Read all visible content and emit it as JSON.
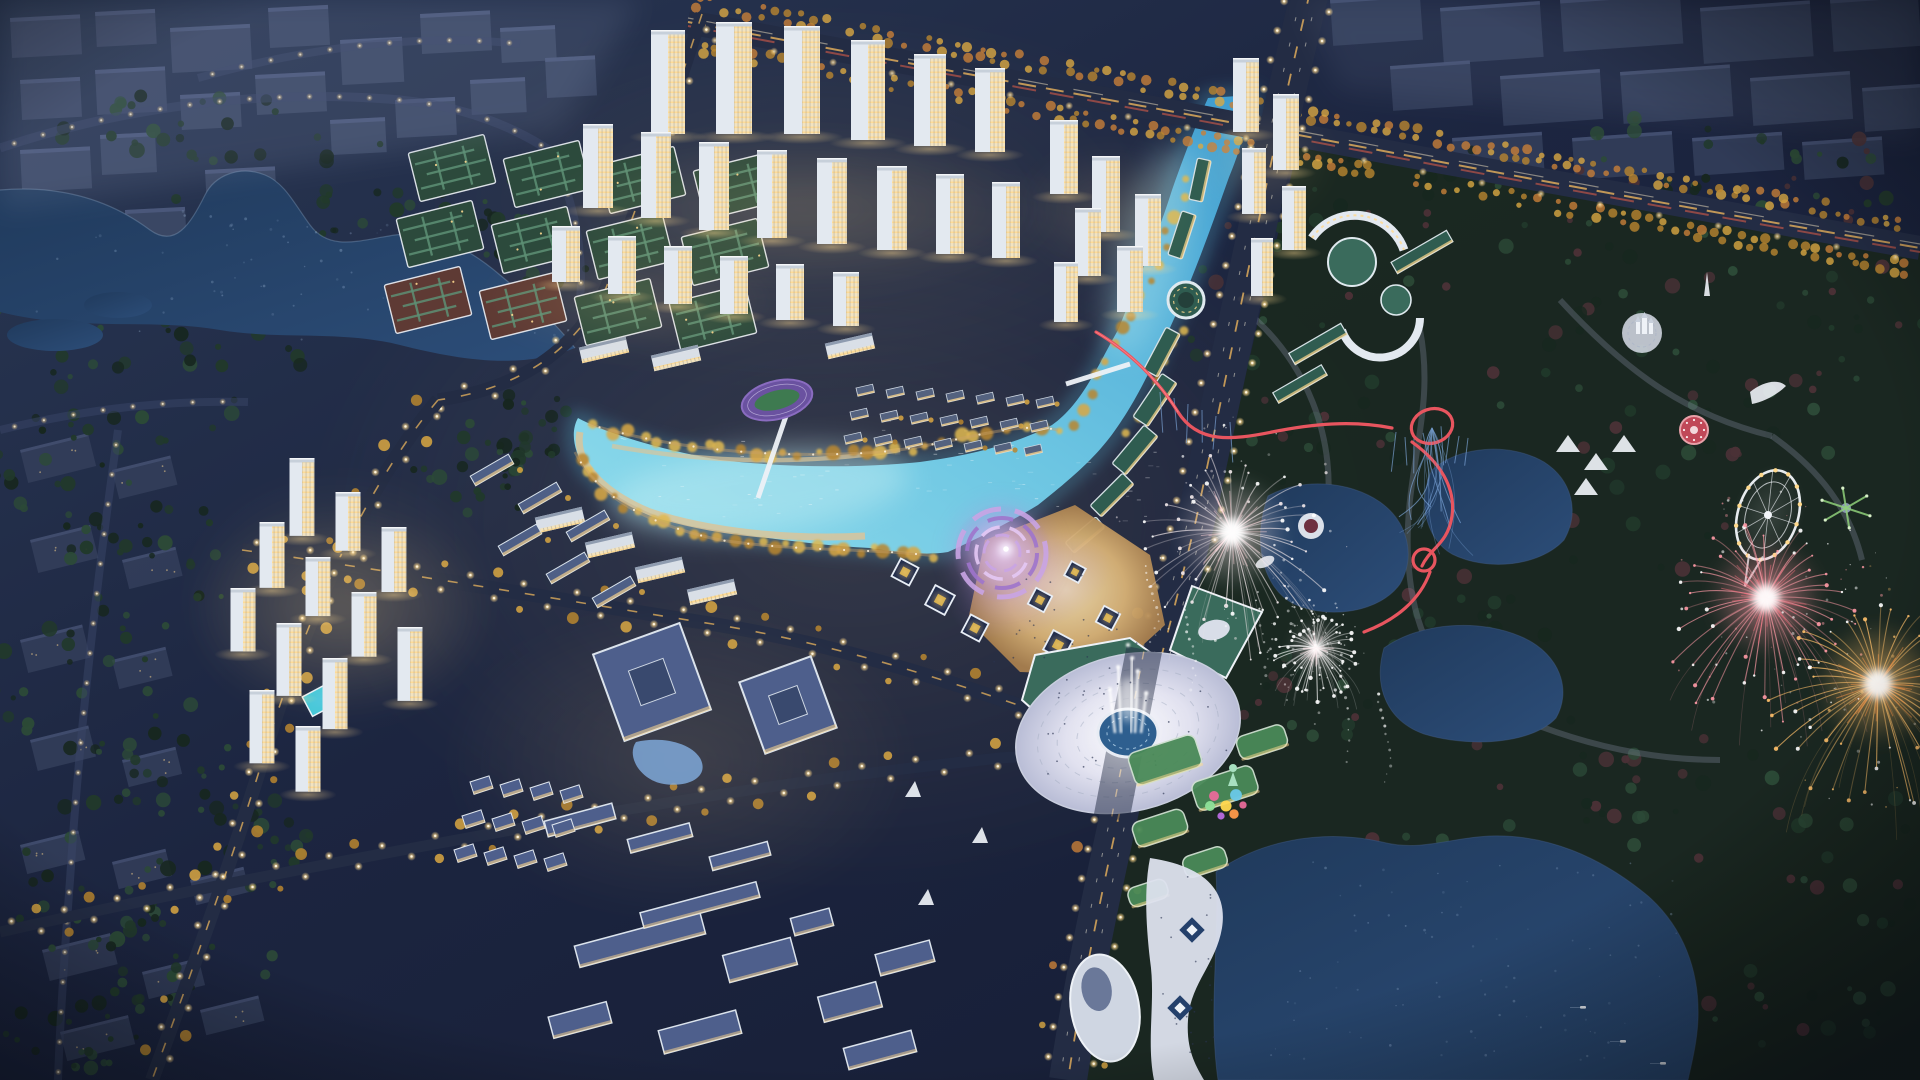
{
  "scene": {
    "title": "Aerial dusk rendering of a riverfront new-town masterplan with amusement park fireworks",
    "time_of_day": "dusk",
    "view": "high oblique aerial perspective",
    "regions": [
      {
        "id": "context-city-nw",
        "label": "Existing muted city blocks, north-west"
      },
      {
        "id": "nw-lake",
        "label": "Natural lake with dark forest shoreline"
      },
      {
        "id": "residential-north",
        "label": "Lit white high-rise residential quarter"
      },
      {
        "id": "courtyard-blocks",
        "label": "Green-roof low-rise courtyard blocks"
      },
      {
        "id": "central-river",
        "label": "Glowing turquoise river and central lagoon with beaches"
      },
      {
        "id": "festival-plaza",
        "label": "Violet-lit circular amphitheatre plaza with pavilions"
      },
      {
        "id": "fountain-roundabout",
        "label": "Elliptical fountain plaza spanning the boulevard"
      },
      {
        "id": "campus",
        "label": "School campus with slate-blue roofs"
      },
      {
        "id": "residential-west",
        "label": "Mid-rise residential cluster with pool clubhouse"
      },
      {
        "id": "riverfront-retail",
        "label": "Green-roof riverfront retail strip with ring pavilion"
      },
      {
        "id": "theme-park",
        "label": "Lakeside amusement park at night"
      },
      {
        "id": "boulevard",
        "label": "Grand lit boulevard"
      },
      {
        "id": "highway",
        "label": "Northern expressway with light trails and autumn trees"
      }
    ],
    "landmarks": [
      {
        "id": "roller-coaster",
        "label": "Red roller coaster with loops"
      },
      {
        "id": "ferris-wheel",
        "label": "Illuminated ferris wheel"
      },
      {
        "id": "firework-white",
        "label": "Large silver-white firework burst"
      },
      {
        "id": "firework-pink",
        "label": "Large pink firework burst"
      },
      {
        "id": "firework-gold",
        "label": "Large golden firework burst"
      },
      {
        "id": "fountain-jets",
        "label": "Central fountain water jets"
      },
      {
        "id": "amphitheatre",
        "label": "Violet concentric amphitheatre"
      },
      {
        "id": "ring-pavilion",
        "label": "Circular green-roof pavilion at river bend"
      },
      {
        "id": "running-track",
        "label": "Purple running track oval"
      },
      {
        "id": "carousel",
        "label": "Carousel ride"
      },
      {
        "id": "swing-ride",
        "label": "Swing ride"
      },
      {
        "id": "castle-plaza",
        "label": "White castle plaza"
      },
      {
        "id": "event-tents",
        "label": "White event tent canopies"
      },
      {
        "id": "candy-corner",
        "label": "Colorful candy-theme corner"
      },
      {
        "id": "pebble-hall",
        "label": "White pebble-shaped hall"
      },
      {
        "id": "boats",
        "label": "Small boats on the lake"
      }
    ]
  },
  "palette": {
    "base1": "#1c2540",
    "base2": "#2a3854",
    "haze": "#8d9ab8",
    "ctx": "#3e4a68",
    "ctxLite": "#57648c",
    "ctxDim": "#343f5c",
    "forest1": "#17271f",
    "forest2": "#21392b",
    "forest3": "#2c4a37",
    "autumn": "#4a3136",
    "lakeDark": "#203a5c",
    "lakeMid": "#2c4d78",
    "lakeSpeck": "#9db8d8",
    "river1": "#8fdcec",
    "river2": "#3e9cd0",
    "riverGlow": "#5ec8e8",
    "sand": "#d9c49a",
    "goldTree1": "#d9a742",
    "goldTree2": "#b9862f",
    "lawn": "#3f7a52",
    "lawnLit": "#5a9a62",
    "mazeGreen": "#5d8f74",
    "courtGreen": "#2c4a3c",
    "courtMaroon": "#5e3a34",
    "road": "#232c44",
    "roadLite": "#3a4668",
    "laneGold": "#e8b35c",
    "laneRed": "#c85848",
    "lightCore": "#fff6e0",
    "lightHalo": "#ffd98c",
    "towerBody": "#e3e9f0",
    "towerRoof": "#c7d0da",
    "towerWarm": "#f3e3bd",
    "winGold": "#ffd98f",
    "slabRoof": "#8f9cb0",
    "campusRoof": "#4e5f8c",
    "campusDark": "#39496e",
    "canopyBlue": "#7fa8d8",
    "greenRoof": "#2f5c50",
    "greenRoofLit": "#3a6b5c",
    "white": "#eef2f7",
    "offWhite": "#d8dde8",
    "purple1": "#c9a4e4",
    "purple2": "#9f74cc",
    "violet": "#e4c8f4",
    "plazaWarm1": "#d8b276",
    "plazaWarm2": "#a87f4e",
    "pool": "#2e5f8f",
    "poolCyan": "#46c8d8",
    "parkBase": "#1a2820",
    "parkPath": "#8a93a8",
    "promenade": "#dde2ee",
    "terraceGreen": "#4a8a58",
    "pebble": "#cfd6e2",
    "coaster": "#e8555f",
    "coasterSup": "#7fa8dc",
    "wheelWhite": "#f2f5fa",
    "wheelGold": "#ffd88a",
    "mint": "#a8e0c0",
    "fwWhite": "#ffffff",
    "fwPink": "#ff9aa6",
    "fwPinkDeep": "#f06a78",
    "fwGold": "#ffc06a",
    "fwGoldDeep": "#ff9848",
    "fwBlue": "#7fa8e0",
    "candy": [
      "#e86a9a",
      "#ffd84f",
      "#6ac8e8",
      "#b86ae0",
      "#ff9a4a",
      "#8fe09a"
    ],
    "boat": "#e8edf4",
    "people": "#2a3350"
  },
  "effects": {
    "firework_rays": 44,
    "street_light_spacing": 27,
    "highway_tree_spacing": 13,
    "park_tree_count": 300,
    "lake_sparkles": 90,
    "river_sparkles": 70
  }
}
